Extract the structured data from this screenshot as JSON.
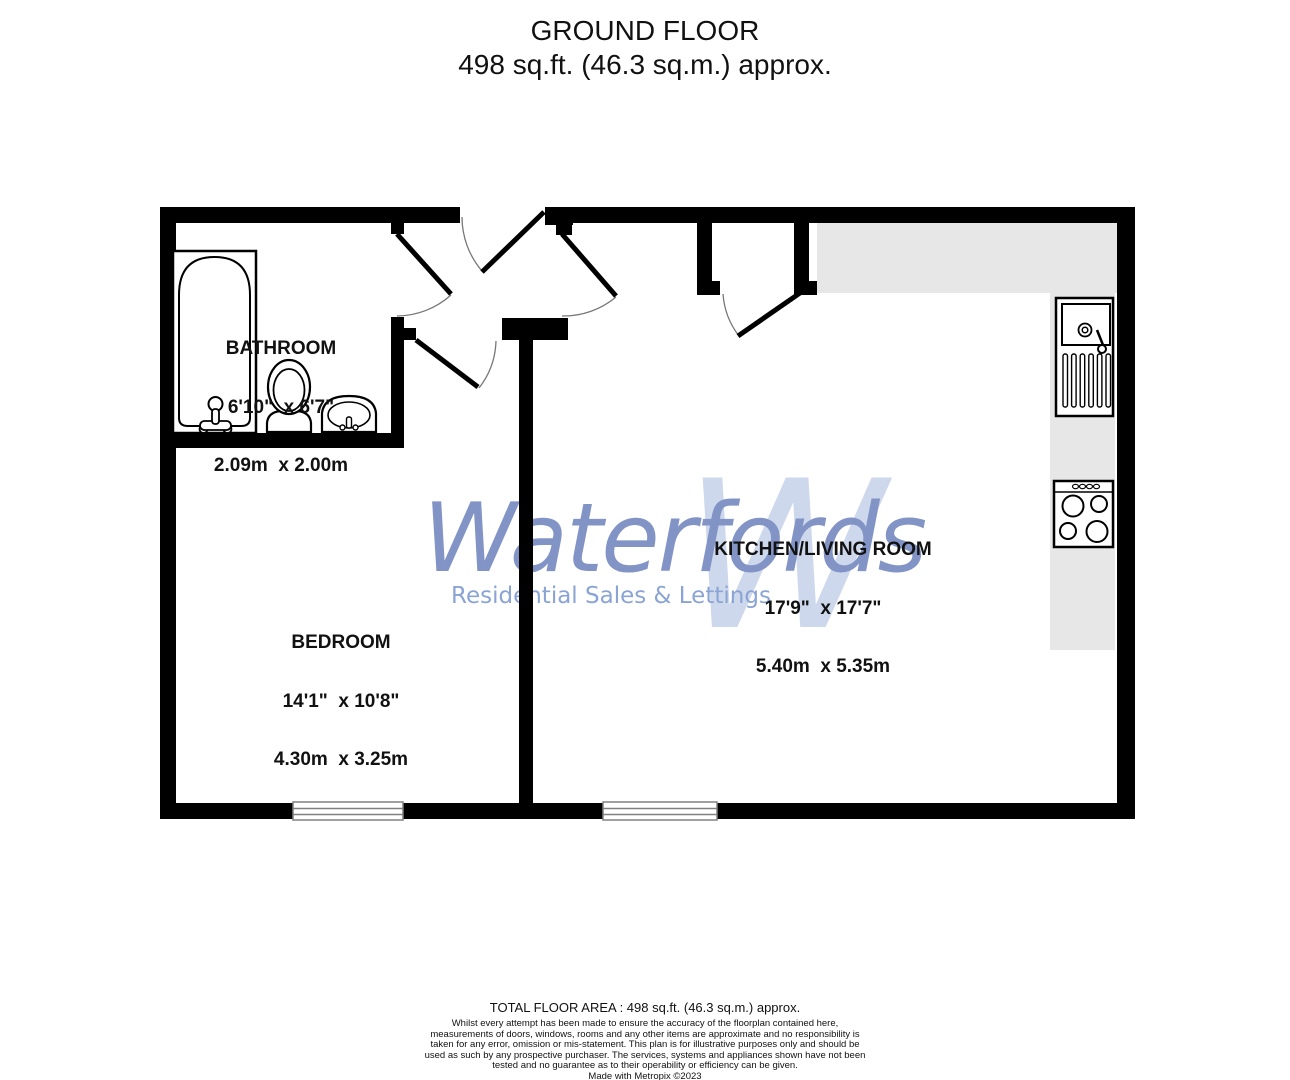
{
  "header": {
    "line1": "GROUND FLOOR",
    "line2": "498 sq.ft. (46.3 sq.m.) approx."
  },
  "watermark": {
    "brand": "Waterfords",
    "tagline": "Residential Sales & Lettings",
    "monogram": "W"
  },
  "rooms": {
    "bathroom": {
      "name": "BATHROOM",
      "imperial": "6'10\"  x 6'7\"",
      "metric": "2.09m  x 2.00m"
    },
    "bedroom": {
      "name": "BEDROOM",
      "imperial": "14'1\"  x 10'8\"",
      "metric": "4.30m  x 3.25m"
    },
    "kitchen_living": {
      "name": "KITCHEN/LIVING ROOM",
      "imperial": "17'9\"  x 17'7\"",
      "metric": "5.40m  x 5.35m"
    }
  },
  "footer": {
    "total_area": "TOTAL FLOOR AREA : 498 sq.ft. (46.3 sq.m.) approx.",
    "disclaimer": "Whilst every attempt has been made to ensure the accuracy of the floorplan contained here, measurements of doors, windows, rooms and any other items are approximate and no responsibility is taken for any error, omission or mis-statement. This plan is for illustrative purposes only and should be used as such by any prospective purchaser. The services, systems and appliances shown have not been tested and no guarantee as to their operability or efficiency can be given.",
    "credit": "Made with Metropix ©2023"
  },
  "colors": {
    "wall": "#000000",
    "counter": "#e7e7e7",
    "brand_blue": "#8294c6",
    "tagline_blue": "#8aa4d3",
    "monogram_blue": "#cdd8ec"
  }
}
